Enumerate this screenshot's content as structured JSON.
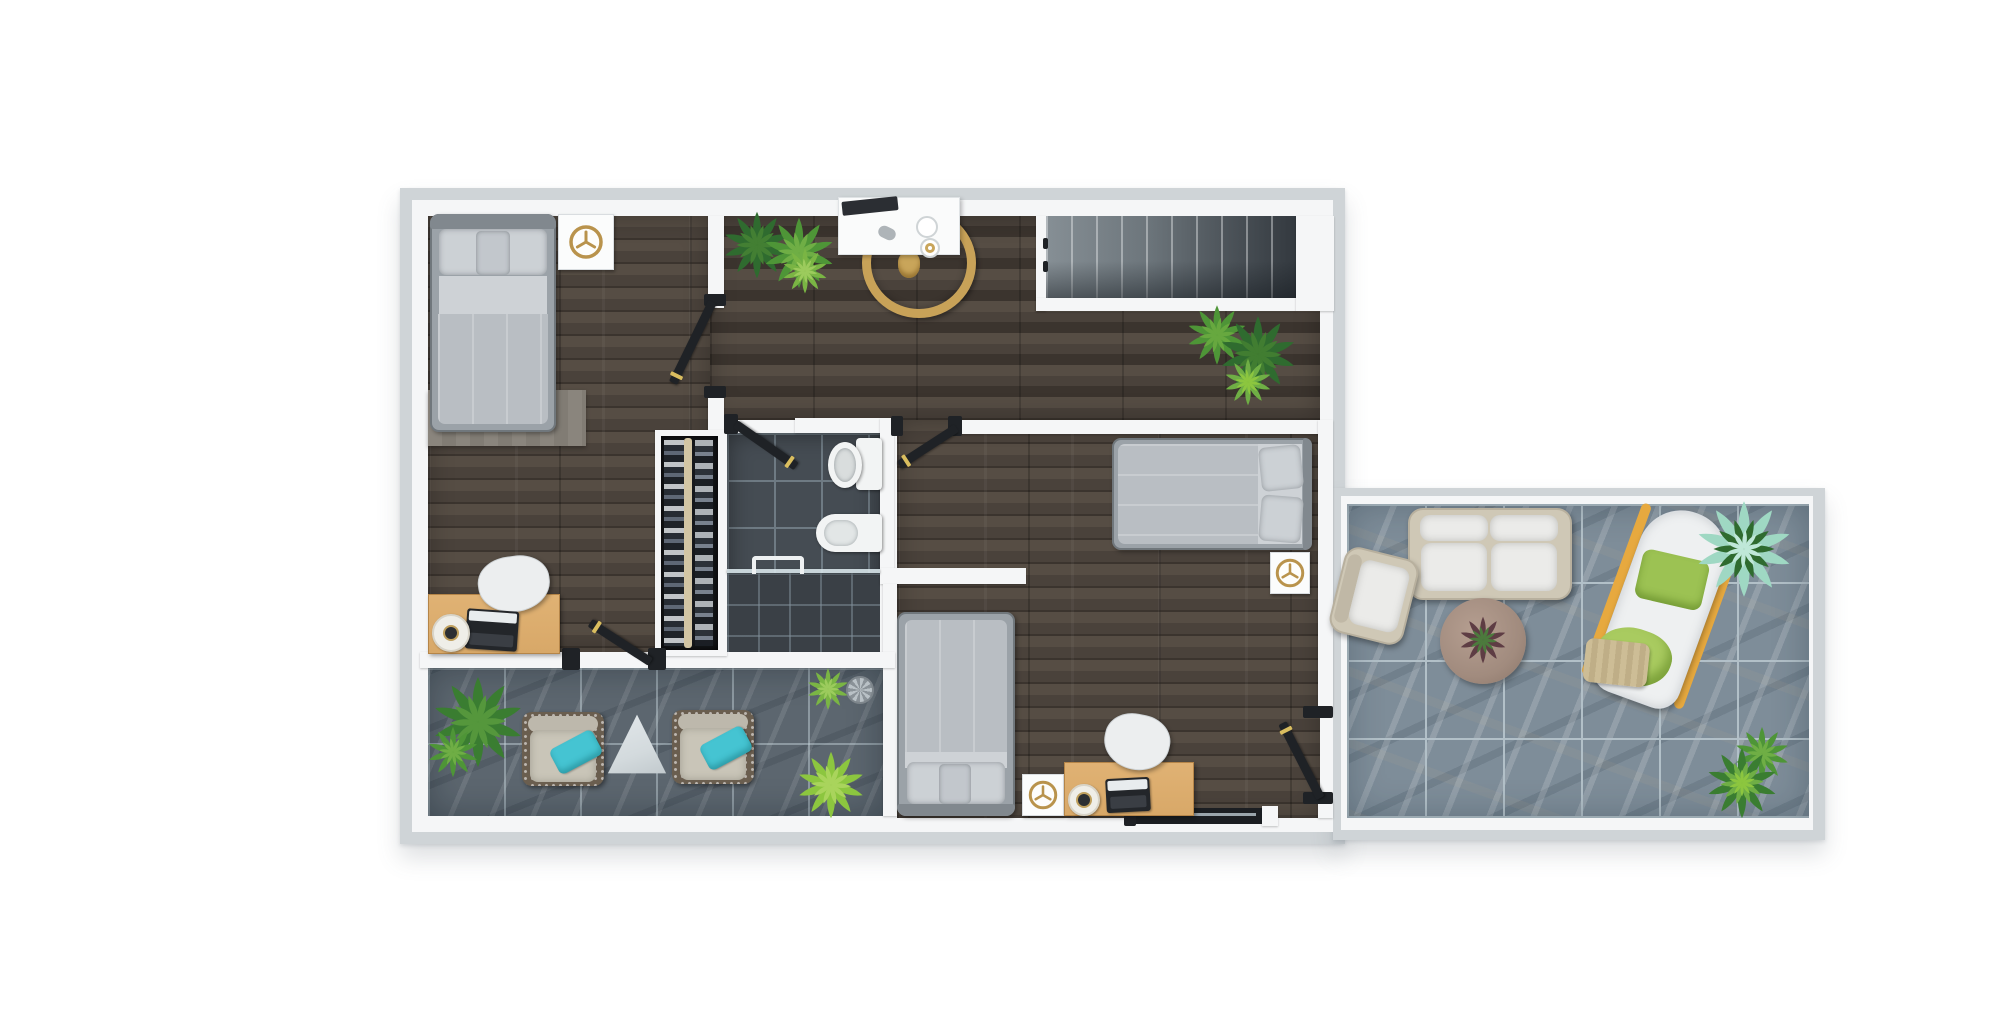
{
  "scene": {
    "type": "3d-rendered floor plan, top-down view",
    "background": "#ffffff",
    "rooms_visible": [
      "bedroom-top-left",
      "hallway",
      "staircase",
      "bathroom",
      "walk-in-closet",
      "bedroom-middle-right",
      "bedroom-bottom-center",
      "terrace-bottom-left",
      "terrace-right"
    ],
    "furniture_visible": [
      "single-bed",
      "double-bed",
      "single-bed",
      "nightstand-with-clock",
      "nightstand-with-clock",
      "nightstand-with-clock",
      "standing-round-mirror",
      "white-console",
      "wood-desk-with-laptop",
      "wood-desk-with-laptop",
      "white-chair",
      "white-chair",
      "toilet",
      "washbasin-fixture",
      "shower-glass",
      "wardrobe-rack",
      "wicker-armchair",
      "wicker-armchair",
      "triangle-side-table",
      "outdoor-sofa",
      "outdoor-armchair",
      "round-coffee-table",
      "sun-lounger",
      "sliding-glass-door",
      "potted-plants",
      "floor-drain"
    ]
  },
  "colors": {
    "page-bg": "#ffffff",
    "outer-wall": "#cfd4d7",
    "inner-wall": "#f5f6f7",
    "wood-base": "#4a423b",
    "wood-light": "#564d44",
    "wood-dark": "#3b342e",
    "wood-runner": "#847b70",
    "rug-gray": "#8a857d",
    "bath-tile": "#454c53",
    "bath-grout": "#6e7a83",
    "shower-tile": "#3a4046",
    "terr-left-tile": "#5c666f",
    "terr-right-tile": "#7e8d99",
    "terr-right-vein": "#b2c0c8",
    "stair-light": "#868f95",
    "stair-dark": "#33393f",
    "door-leaf": "#1f2226",
    "door-gold": "#d9bd5f",
    "bed-frame": "#9ba2a8",
    "bed-blanket": "#b9bec3",
    "bed-sheet": "#ced2d6",
    "bed-pillow": "#ccd1d5",
    "desk-wood": "#d8a868",
    "chair-white": "#eceeef",
    "closet-bg": "#16181c",
    "closet-rod": "#d2c5a4",
    "gold": "#b9934c",
    "sofa-white": "#ebebe9",
    "wicker": "#cfc8b6",
    "wicker-dark": "#6a5e4f",
    "lounger-frame": "#e7a93f",
    "green-pillow": "#9cc253",
    "green-throw": "#a9cb60",
    "teal": "#45c4d2",
    "cushion-beige": "#c9c5b8",
    "table-wood": "#a18b7e",
    "tri-table": "#d3dadd",
    "plant-dark": "#2f6b2f",
    "plant-mid": "#4e9537",
    "plant-light": "#8cc63f",
    "plant-mint": "#9fd8c3",
    "fixture": "#f2f4f4"
  }
}
